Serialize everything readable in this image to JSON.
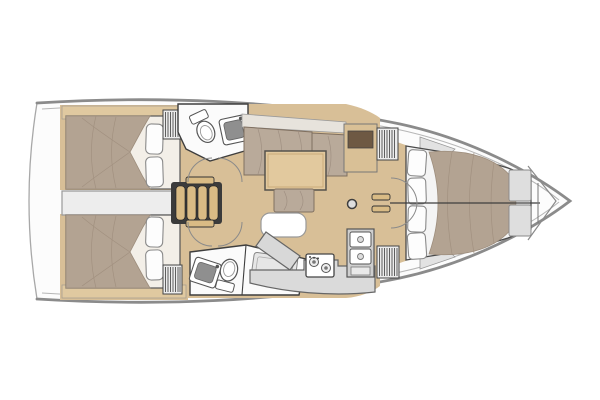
{
  "document": {
    "title": "Sailing yacht interior floor plan",
    "view": "overhead deck plan, bow to the right, stern to the left"
  },
  "colors": {
    "background": "#ffffff",
    "hull_fill": "#fcfcfc",
    "hull_stroke": "#8b8b8b",
    "transom_stroke": "#a8a8a8",
    "inner_hull_stroke": "#b6b6b6",
    "outline_dark": "#3e3e3e",
    "wood_sole": "#d8bf97",
    "wood_shelf": "#e0c9a0",
    "wood_table": "#e2c99e",
    "wood_steps": "#d9bb85",
    "wood_cabinet": "#d9c096",
    "cabinet_inset": "#6e5943",
    "duvet": "#b3a392",
    "duvet_stroke": "#9d8d7c",
    "cushion": "#b9aa9a",
    "cushion_back": "#e7e3dc",
    "pillow": "#fdfdfd",
    "linen_white": "#f3efe8",
    "counter_gray": "#d8d8d8",
    "fixture_white": "#ffffff",
    "basin_gray": "#8f8f8f",
    "engine_gray": "#ededed",
    "locker_gray": "#ececec",
    "platform_white": "#f4f4f4",
    "panel_gray": "#dedede",
    "stair_frame": "#3b3b3b"
  },
  "layout": {
    "rooms": [
      {
        "name": "aft-cabin-port",
        "features": [
          "double berth",
          "two pillows",
          "hanging locker",
          "aft shelf"
        ]
      },
      {
        "name": "aft-cabin-starboard",
        "features": [
          "double berth",
          "two pillows",
          "hanging locker",
          "aft shelf"
        ]
      },
      {
        "name": "head-port",
        "features": [
          "marine toilet",
          "vanity sink"
        ]
      },
      {
        "name": "head-starboard",
        "features": [
          "marine toilet",
          "vanity sink",
          "shower bench"
        ]
      },
      {
        "name": "saloon",
        "features": [
          "L-settee",
          "dining table",
          "bench seat",
          "island seat",
          "cabinet",
          "mast post"
        ]
      },
      {
        "name": "galley",
        "features": [
          "two-burner stove",
          "double sink",
          "angled counter",
          "fridge locker"
        ]
      },
      {
        "name": "forward-cabin",
        "features": [
          "V-berth",
          "four pillows",
          "hanging lockers",
          "double doors"
        ]
      },
      {
        "name": "bow",
        "features": [
          "anchor locker bulkhead"
        ]
      }
    ],
    "companionway_steps": 4,
    "engine_compartment_under_companionway": true
  }
}
